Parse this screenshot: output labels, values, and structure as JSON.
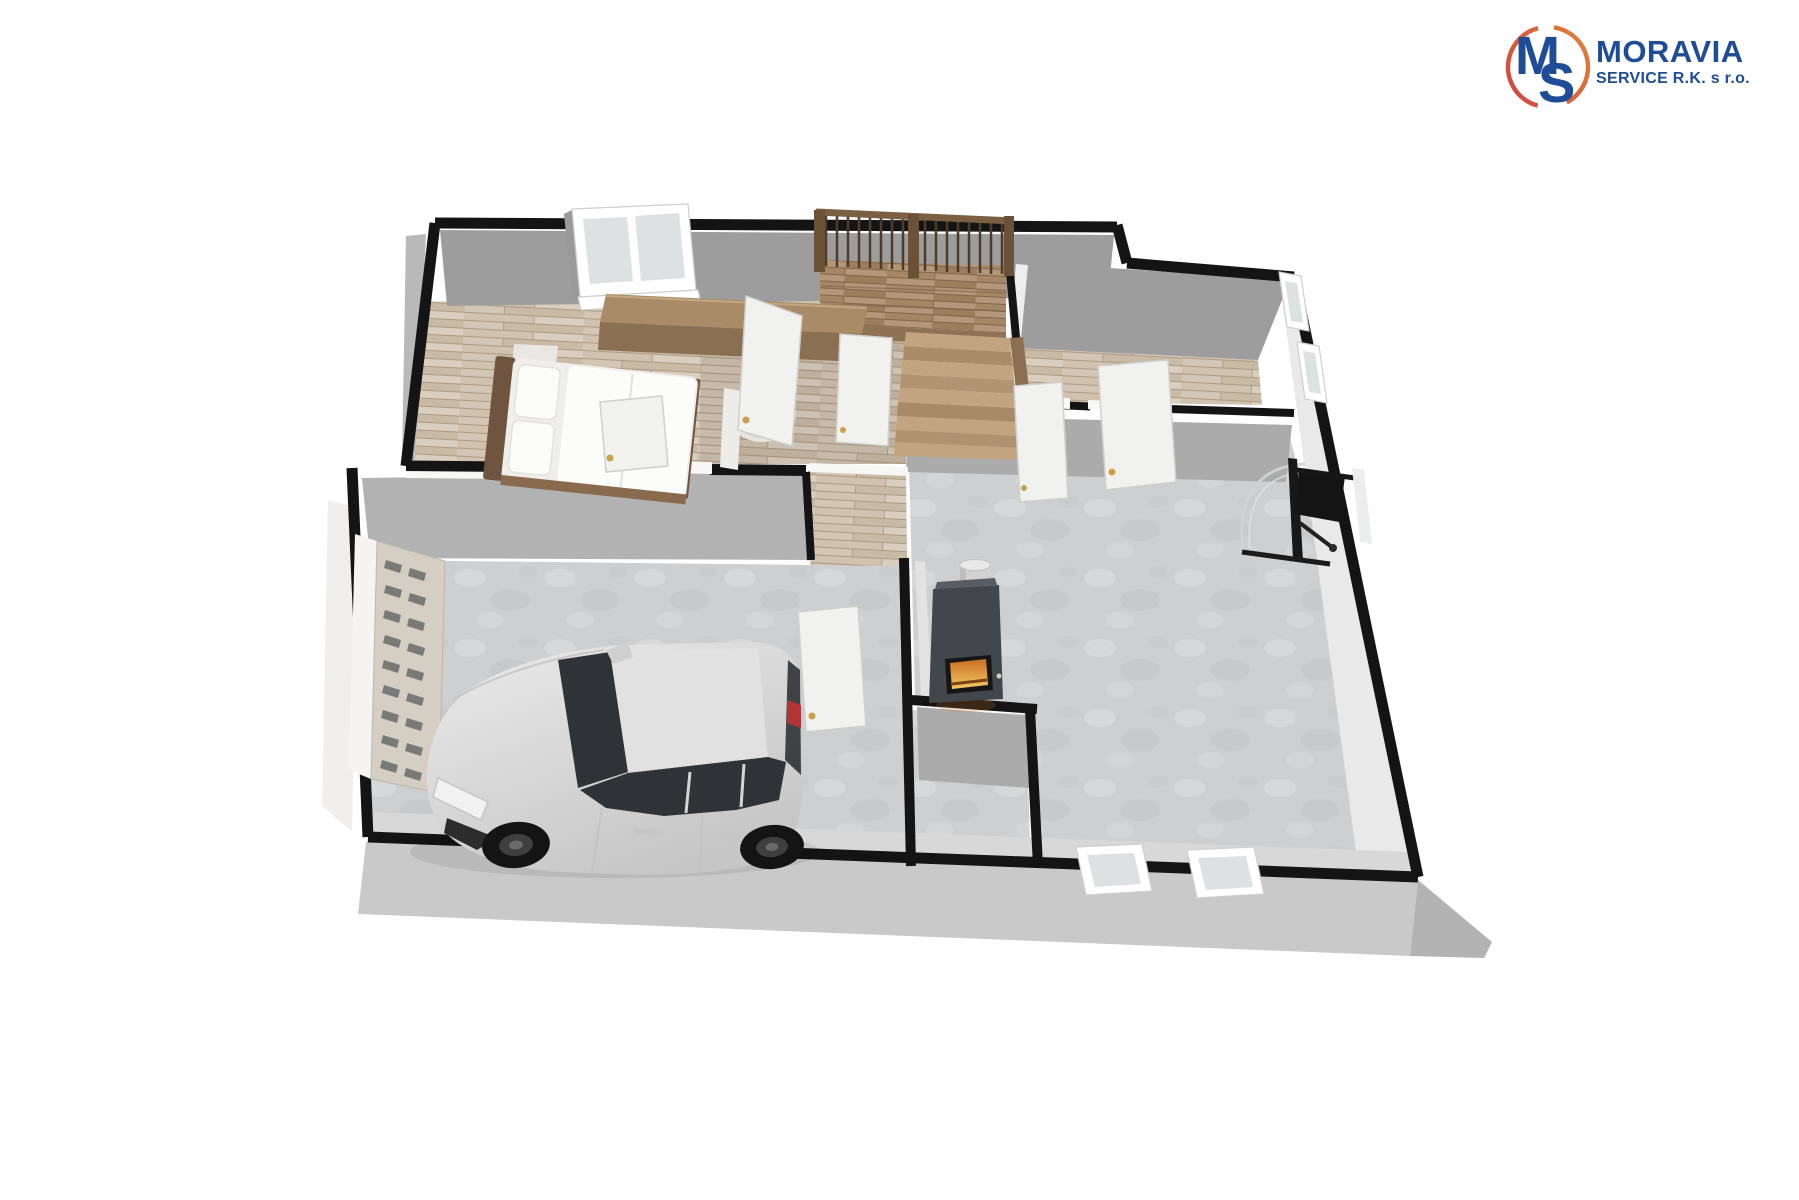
{
  "page": {
    "background_color": "#ffffff",
    "description": "3D dollhouse-style floor plan rendering of a ground floor with garage, staircase and rooms"
  },
  "logo": {
    "monogram_m": "M",
    "monogram_s": "S",
    "title": "MORAVIA",
    "subtitle": "SERVICE R.K. s r.o."
  },
  "floorplan": {
    "view": "axonometric-3d-render",
    "rooms": [
      {
        "name": "bedroom",
        "floor": "wood",
        "furniture": [
          "double-bed",
          "nightstand",
          "sideboard",
          "armchair"
        ],
        "openings": [
          "tilted-double-window"
        ]
      },
      {
        "name": "stair-hall",
        "floor": "wood",
        "features": [
          "wooden-staircase",
          "balustrade-railing",
          "under-stairs-door"
        ]
      },
      {
        "name": "upper-corridor",
        "floor": "wood",
        "features": [
          "open-white-doors-with-gold-handles"
        ]
      },
      {
        "name": "garage",
        "floor": "concrete",
        "features": [
          "silver-suv-car",
          "sectional-garage-door-with-small-windows"
        ]
      },
      {
        "name": "utility-area",
        "floor": "concrete",
        "features": [
          "wood-burning-stove-with-steel-flue",
          "fire-glow"
        ]
      },
      {
        "name": "large-concrete-room",
        "floor": "concrete",
        "features": [
          "dark-fitness-equipment",
          "two-south-windows"
        ]
      },
      {
        "name": "small-storage-room",
        "floor": "concrete"
      }
    ],
    "window_count": 5,
    "door_leaf_count": 6
  },
  "colors": {
    "wall_black": "#141414",
    "wall_face": "#9d9d9d",
    "wall_face_mid": "#ababab",
    "wall_face_light": "#e9e9e9",
    "wall_white": "#f7f7f6",
    "wood_base": "#d8cdbe",
    "wood_dark": "#c2b09a",
    "wood_seam": "#ad9a82",
    "stair_base": "#b49678",
    "stair_dark": "#8c6f51",
    "stair_stripe": "#a58766",
    "rail_wood": "#6b5138",
    "concrete": "#cdcfd1",
    "concrete_light": "#dadcde",
    "concrete_dark": "#c2c4c6",
    "skirt": "#c9c9c9",
    "skirt_dark": "#b3b3b3",
    "door_leaf": "#f1f1ef",
    "door_edge": "#cfcfcc",
    "handle_gold": "#c9a24b",
    "glass": "#dde1e2",
    "window_frame": "#ffffff",
    "stove_body": "#42474b",
    "stove_top": "#585d61",
    "flue": "#d2d2d2",
    "fire_deep": "#c96f22",
    "fire_bright": "#f4c964",
    "car_body": "#dcdcdc",
    "car_glass": "#2f3335",
    "taillight": "#b23434",
    "furn_top": "#a98b68",
    "furn_front": "#8a6f52",
    "bed_frame": "#6f5440",
    "logo_blue": "#1e4c96",
    "logo_red": "#d0433e",
    "logo_orange": "#e2823c"
  }
}
